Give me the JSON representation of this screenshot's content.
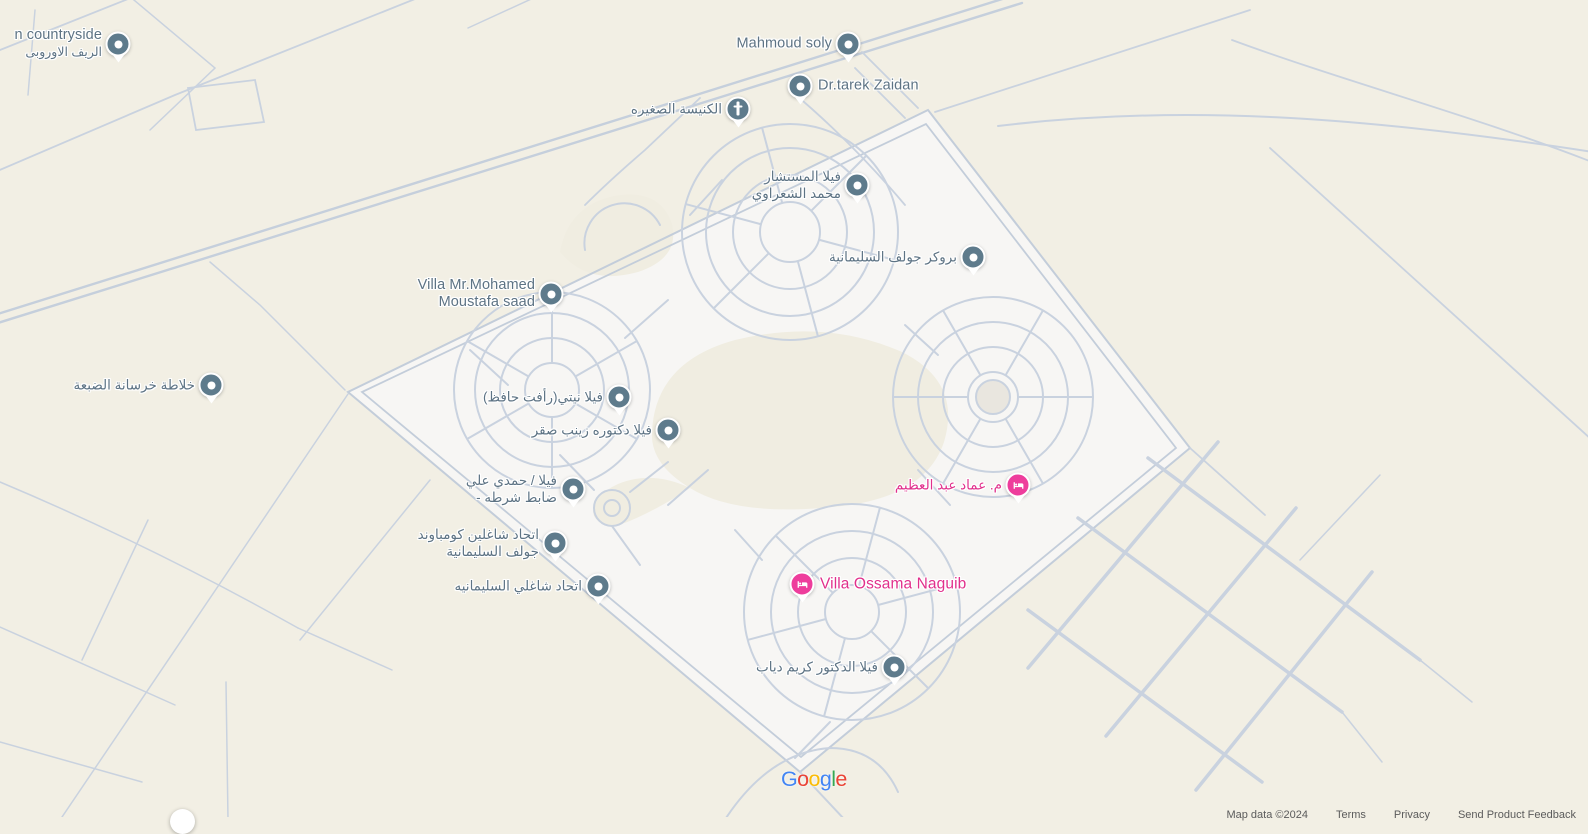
{
  "colors": {
    "background": "#f2efe4",
    "compound_fill": "#f7f6f4",
    "inner_sand": "#f0ede1",
    "road": "#c9d2df",
    "poi_pin": "#5e7b8c",
    "poi_label": "#5d7384",
    "lodging_pin": "#ee3d9c",
    "lodging_label": "#e1308c"
  },
  "markers": [
    {
      "name": "european-countryside",
      "line1": "n countryside",
      "line2": "الريف الاوروبى"
    },
    {
      "name": "mahmoud-soly",
      "line1": "Mahmoud soly"
    },
    {
      "name": "dr-tarek-zaidan",
      "line1": "Dr.tarek Zaidan"
    },
    {
      "name": "small-church",
      "line1": "الكنيسة الصغيره"
    },
    {
      "name": "villa-elmostashar-elsharawy",
      "line1": "فيلا المستشار",
      "line2": "محمد الشعراوي"
    },
    {
      "name": "broker-golf-elsolimaneya",
      "line1": "بروكر جولف السليمانية"
    },
    {
      "name": "villa-mohamed-moustafa-saad",
      "line1": "Villa Mr.Mohamed",
      "line2": "Moustafa saad"
    },
    {
      "name": "concrete-mixer-eldabaa",
      "line1": "خلاطة خرسانة الضبعة"
    },
    {
      "name": "villa-nety-rafat-hafez",
      "line1": "فيلا نيتي(رأفت حافظ)"
    },
    {
      "name": "villa-dr-zeinab-sakr",
      "line1": "فيلا دكتوره زينب صقر"
    },
    {
      "name": "villa-hamdy-aly",
      "line1": "فيلا / حمدي علي",
      "line2": "- ضابط شرطه"
    },
    {
      "name": "residents-union-golf-compound",
      "line1": "اتحاد شاغلين كومباوند",
      "line2": "جولف السليمانية"
    },
    {
      "name": "residents-union-solimaneya",
      "line1": "اتحاد شاغلي السليمانيه"
    },
    {
      "name": "emad-abdelazim",
      "line1": "م. عماد عبد العظيم"
    },
    {
      "name": "villa-ossama-naguib",
      "line1": "Villa Ossama Naguib"
    },
    {
      "name": "villa-dr-karim-diab",
      "line1": "فيلا الدكتور كريم دياب"
    }
  ],
  "footer": {
    "logo_letters": [
      {
        "ch": "G",
        "color": "#4285F4"
      },
      {
        "ch": "o",
        "color": "#EA4335"
      },
      {
        "ch": "o",
        "color": "#FBBC05"
      },
      {
        "ch": "g",
        "color": "#4285F4"
      },
      {
        "ch": "l",
        "color": "#34A853"
      },
      {
        "ch": "e",
        "color": "#EA4335"
      }
    ],
    "attribution": {
      "map_data": "Map data ©2024",
      "terms": "Terms",
      "privacy": "Privacy",
      "feedback": "Send Product Feedback"
    }
  }
}
